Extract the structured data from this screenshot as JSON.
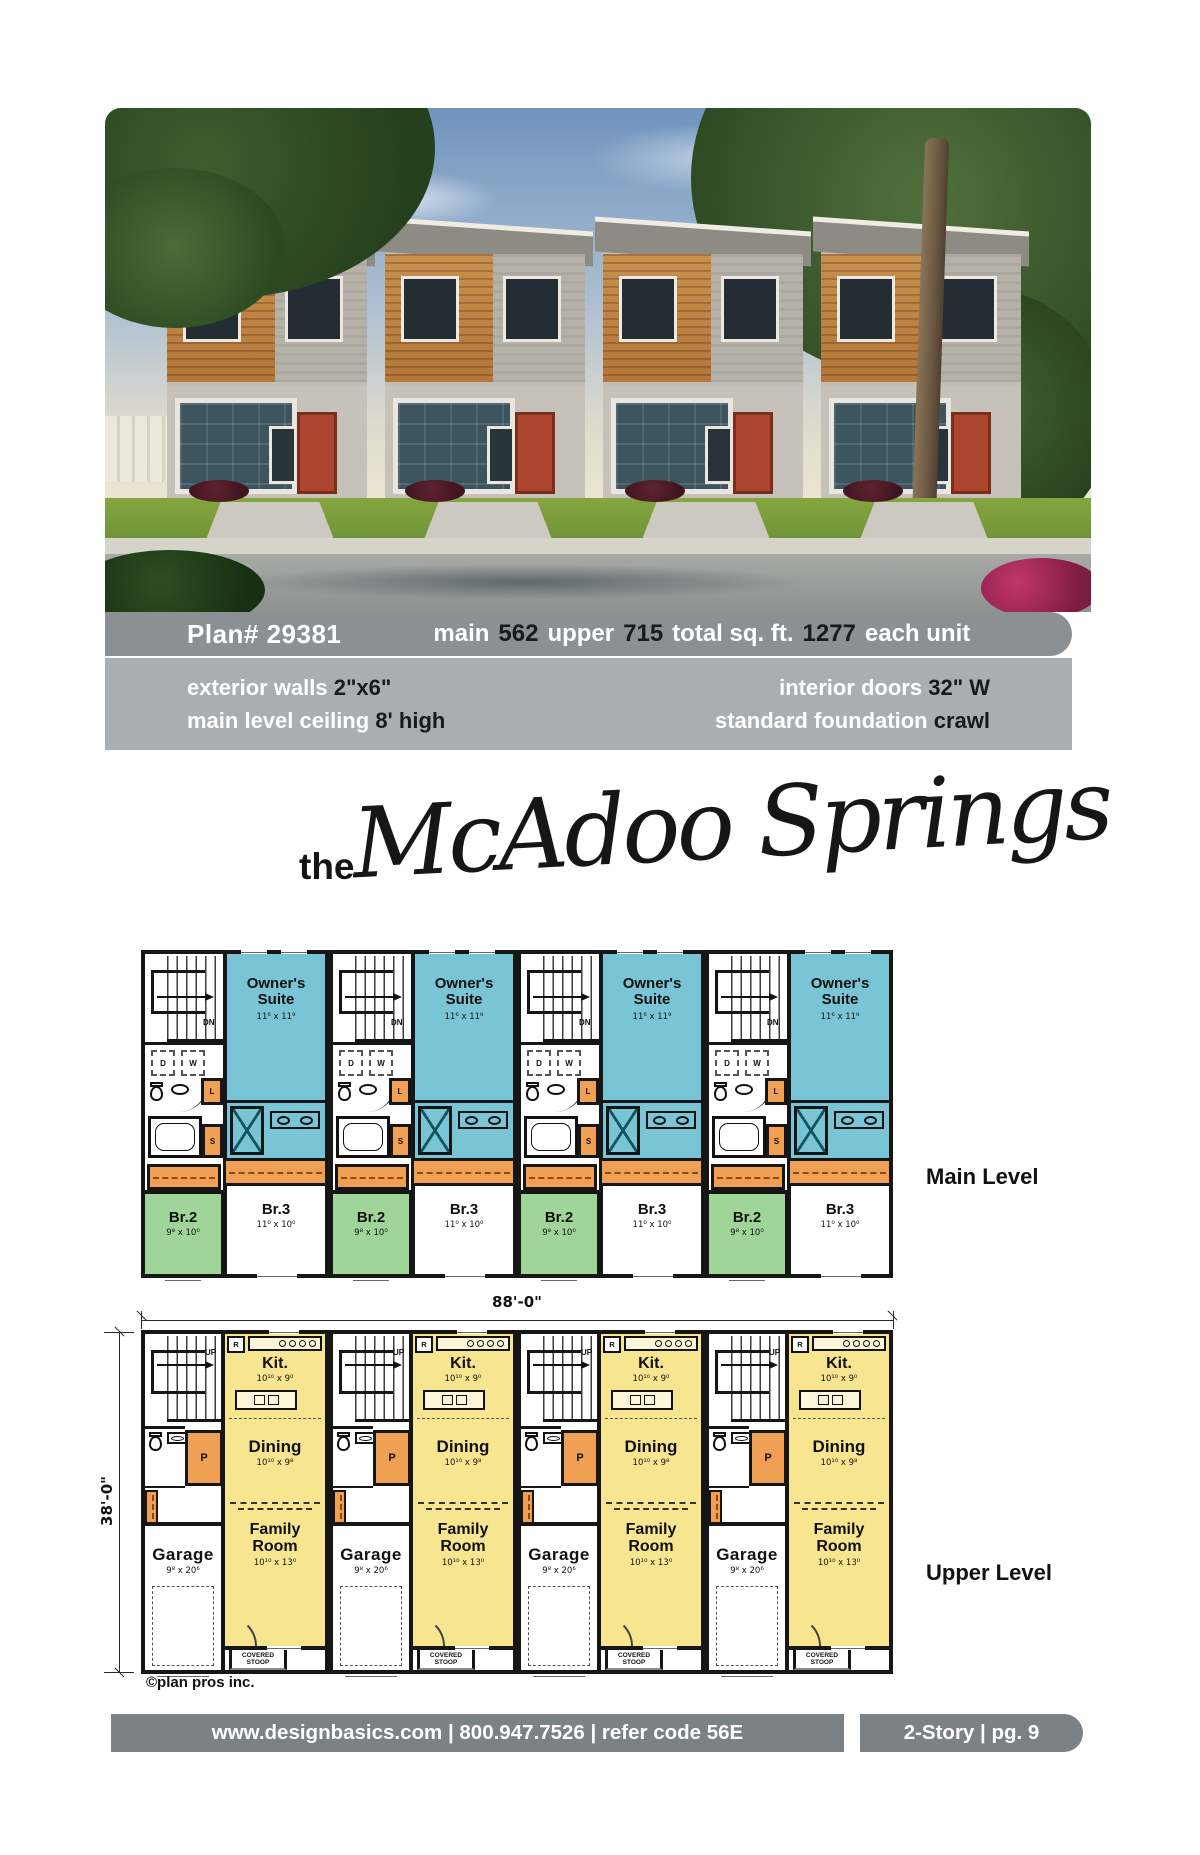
{
  "banner": {
    "plan": "Plan# 29381",
    "spec1_label": "main",
    "spec1_value": "562",
    "spec2_label": "upper",
    "spec2_value": "715",
    "spec3_label": "total sq. ft.",
    "spec3_value": "1277",
    "spec4_label": "each unit"
  },
  "info": {
    "left": [
      {
        "label": "exterior walls",
        "value": "2\"x6\""
      },
      {
        "label": "main level ceiling",
        "value": "8' high"
      }
    ],
    "right": [
      {
        "label": "interior doors",
        "value": "32\" W"
      },
      {
        "label": "standard foundation",
        "value": "crawl"
      }
    ]
  },
  "title": {
    "prefix": "the",
    "name": "McAdoo Springs"
  },
  "main_level": {
    "label": "Main Level",
    "owners_suite": {
      "name": "Owner's Suite",
      "dims": "11⁶ x 11⁹"
    },
    "br3": {
      "name": "Br.3",
      "dims": "11⁰ x 10⁰"
    },
    "br2": {
      "name": "Br.2",
      "dims": "9⁸ x 10⁰"
    },
    "stair": "DN",
    "dryer": "D",
    "washer": "W",
    "linen": "L",
    "shelf": "S"
  },
  "upper_level": {
    "label": "Upper Level",
    "kitchen": {
      "name": "Kit.",
      "dims": "10¹⁰ x 9⁰"
    },
    "dining": {
      "name": "Dining",
      "dims": "10¹⁰ x 9⁸"
    },
    "family_room": {
      "name": "Family Room",
      "dims": "10¹⁰ x 13⁰"
    },
    "garage": {
      "name": "Garage",
      "dims": "9⁸ x 20⁶"
    },
    "stoop": "COVERED STOOP",
    "pantry": "P",
    "fridge": "R",
    "stair": "UP"
  },
  "dimensions": {
    "width": "88'-0\"",
    "height": "38'-0\""
  },
  "copyright": "©plan pros inc.",
  "footer": {
    "left": "www.designbasics.com | 800.947.7526 | refer code 56E",
    "right": "2-Story | pg. 9"
  },
  "colors": {
    "suite_teal": "#79c4d5",
    "bedroom_green": "#a0d599",
    "living_yellow": "#f7e58f",
    "furniture_orange": "#f0a055",
    "banner_gray": "#8b9095",
    "band_gray": "#a9aeb3",
    "footer_gray": "#7b8286"
  }
}
